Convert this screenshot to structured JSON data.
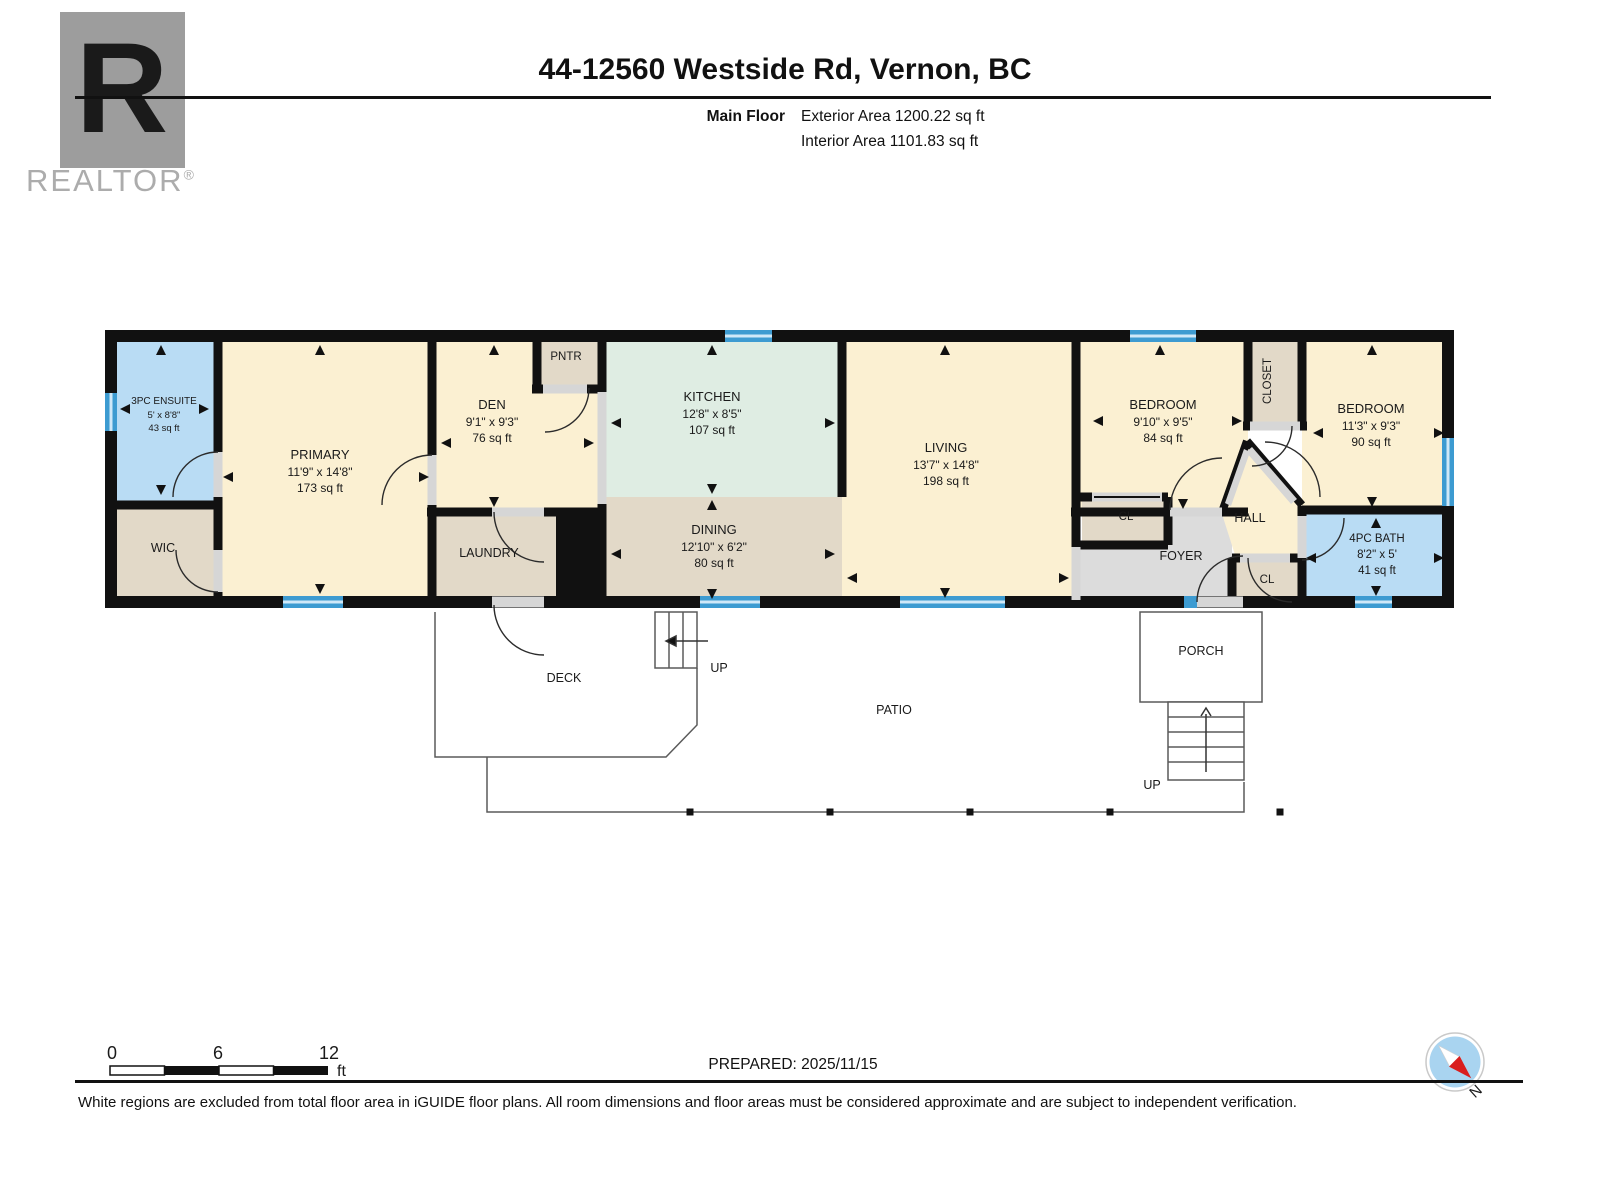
{
  "header": {
    "brand_letter": "R",
    "brand_name": "REALTOR",
    "brand_reg": "®",
    "title": "44-12560 Westside Rd, Vernon, BC",
    "floor_label": "Main Floor",
    "exterior_area": "Exterior Area 1200.22 sq ft",
    "interior_area": "Interior Area 1101.83 sq ft"
  },
  "rooms": {
    "ensuite": {
      "name": "3PC ENSUITE",
      "dims": "5' x 8'8\"",
      "area": "43 sq ft"
    },
    "wic": {
      "name": "WIC"
    },
    "primary": {
      "name": "PRIMARY",
      "dims": "11'9\" x 14'8\"",
      "area": "173 sq ft"
    },
    "den": {
      "name": "DEN",
      "dims": "9'1\" x 9'3\"",
      "area": "76 sq ft"
    },
    "pntr": {
      "name": "PNTR"
    },
    "laundry": {
      "name": "LAUNDRY"
    },
    "kitchen": {
      "name": "KITCHEN",
      "dims": "12'8\" x 8'5\"",
      "area": "107 sq ft"
    },
    "dining": {
      "name": "DINING",
      "dims": "12'10\" x 6'2\"",
      "area": "80 sq ft"
    },
    "living": {
      "name": "LIVING",
      "dims": "13'7\" x 14'8\"",
      "area": "198 sq ft"
    },
    "bedroom1": {
      "name": "BEDROOM",
      "dims": "9'10\" x 9'5\"",
      "area": "84 sq ft"
    },
    "closet": {
      "name": "CLOSET"
    },
    "cl_bedroom1": {
      "name": "CL"
    },
    "hall": {
      "name": "HALL"
    },
    "foyer": {
      "name": "FOYER"
    },
    "cl_foyer": {
      "name": "CL"
    },
    "bedroom2": {
      "name": "BEDROOM",
      "dims": "11'3\" x 9'3\"",
      "area": "90 sq ft"
    },
    "bath": {
      "name": "4PC BATH",
      "dims": "8'2\" x 5'",
      "area": "41 sq ft"
    }
  },
  "outdoor": {
    "deck": "DECK",
    "patio": "PATIO",
    "porch": "PORCH",
    "deck_stairs_label": "UP",
    "porch_stairs_label": "UP"
  },
  "footer": {
    "scale_ticks": [
      "0",
      "6",
      "12"
    ],
    "scale_unit": "ft",
    "prepared": "PREPARED: 2025/11/15",
    "compass_north": "N",
    "disclaimer": "White regions are excluded from total floor area in iGUIDE floor plans. All room dimensions and floor areas must be considered approximate and are subject to independent verification."
  },
  "colors": {
    "room_cream": "#FBF0D2",
    "room_blue": "#B9DCF4",
    "room_mint": "#DFEDE3",
    "room_beige": "#E2D9C8",
    "room_gray": "#DCDCDC",
    "wall": "#111111",
    "window": "#3D9BD1",
    "brand_gray": "#9D9D9D"
  }
}
